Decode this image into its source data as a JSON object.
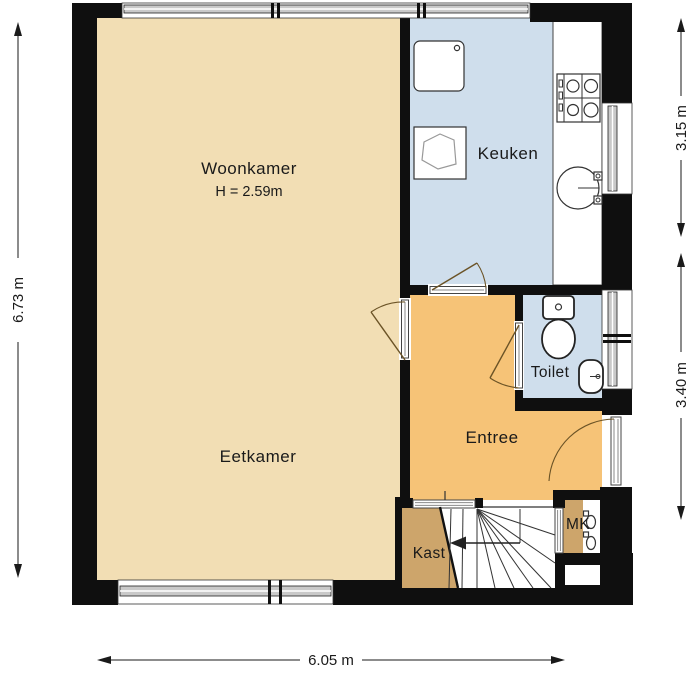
{
  "plan": {
    "type": "floorplan",
    "rooms": {
      "woonkamer": {
        "label": "Woonkamer",
        "sublabel": "H = 2.59m"
      },
      "eetkamer": {
        "label": "Eetkamer"
      },
      "keuken": {
        "label": "Keuken"
      },
      "toilet": {
        "label": "Toilet"
      },
      "entree": {
        "label": "Entree"
      },
      "kast": {
        "label": "Kast"
      },
      "mk": {
        "label": "MK"
      }
    },
    "dimensions": {
      "left": "6.73 m",
      "right_top": "3.15 m",
      "right_bottom": "3.40 m",
      "bottom": "6.05 m"
    },
    "colors": {
      "wall": "#0f0f0f",
      "floor_living": "#f2deb4",
      "floor_entree": "#f6c377",
      "floor_wet": "#cfdeec",
      "floor_closet": "#cda56b",
      "window_glass": "#c9c9c9",
      "stairs": "#ffffff"
    }
  }
}
